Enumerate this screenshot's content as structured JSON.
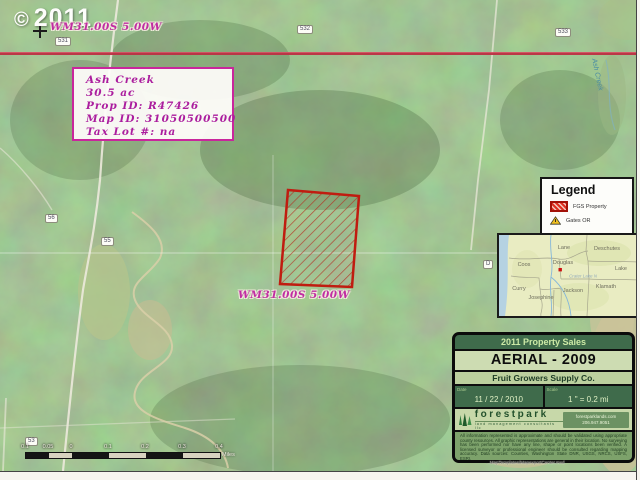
{
  "watermark": {
    "symbol": "©",
    "year": "2011"
  },
  "map_labels": {
    "township_top": "WM31.00S 5.00W",
    "township_mid": "WM31.00S 5.00W",
    "creek": "Ash Creek",
    "roads": [
      "531",
      "532",
      "533",
      "56",
      "55",
      "53",
      "D"
    ]
  },
  "info_box": {
    "name": "Ash Creek",
    "acreage": "30.5 ac",
    "prop_id": "Prop ID: R47426",
    "map_id": "Map ID: 31050500500",
    "tax_lot": "Tax Lot #: na"
  },
  "legend": {
    "title": "Legend",
    "items": [
      {
        "label": "FGS Property",
        "symbol": "red-hatched-parcel"
      },
      {
        "label": "Gates OR",
        "symbol": "yellow-triangle"
      }
    ]
  },
  "inset_map": {
    "counties": [
      "Lane",
      "Deschutes",
      "Coos",
      "Douglas",
      "Lake",
      "Curry",
      "Josephine",
      "Jackson",
      "Klamath"
    ],
    "watermark": "Crater Lake N",
    "marker_color": "#cc1111"
  },
  "panel": {
    "title": "2011 Property Sales",
    "subtitle": "AERIAL - 2009",
    "company": "Fruit Growers Supply Co.",
    "date_label": "Date",
    "date_value": "11 / 22 / 2010",
    "scale_label": "Scale",
    "scale_value": "1 \" = 0.2 mi",
    "logo_text": "forestpark",
    "logo_tagline": "land management consultants llc",
    "contact_web": "forestparklands.com",
    "contact_phone": "206.947.9051",
    "disclaimer": "All information represented is approximate and should be validated using appropriate county resources.  All graphic representations are general in their location. No surveying has been performed nor have any line, shape or point locations been verified. A licensed surveyor or professional engineer should be consulted regarding mapping accuracy.    Data sources: Counties, Washington State DNR, USGS, NRCS, USFS, ESRI."
  },
  "scalebar": {
    "labels": [
      "0.1",
      "0.05",
      "0",
      "0.1",
      "0.2",
      "0.3",
      "0.4"
    ],
    "unit": "Miles"
  },
  "footer_path": "...MapTemplates/MapexportCenter.mxd",
  "colors": {
    "property_outline": "#c01c10",
    "township_line": "#d84a60",
    "label_magenta": "#c02da2",
    "panel_green": "#3f6b4b"
  }
}
